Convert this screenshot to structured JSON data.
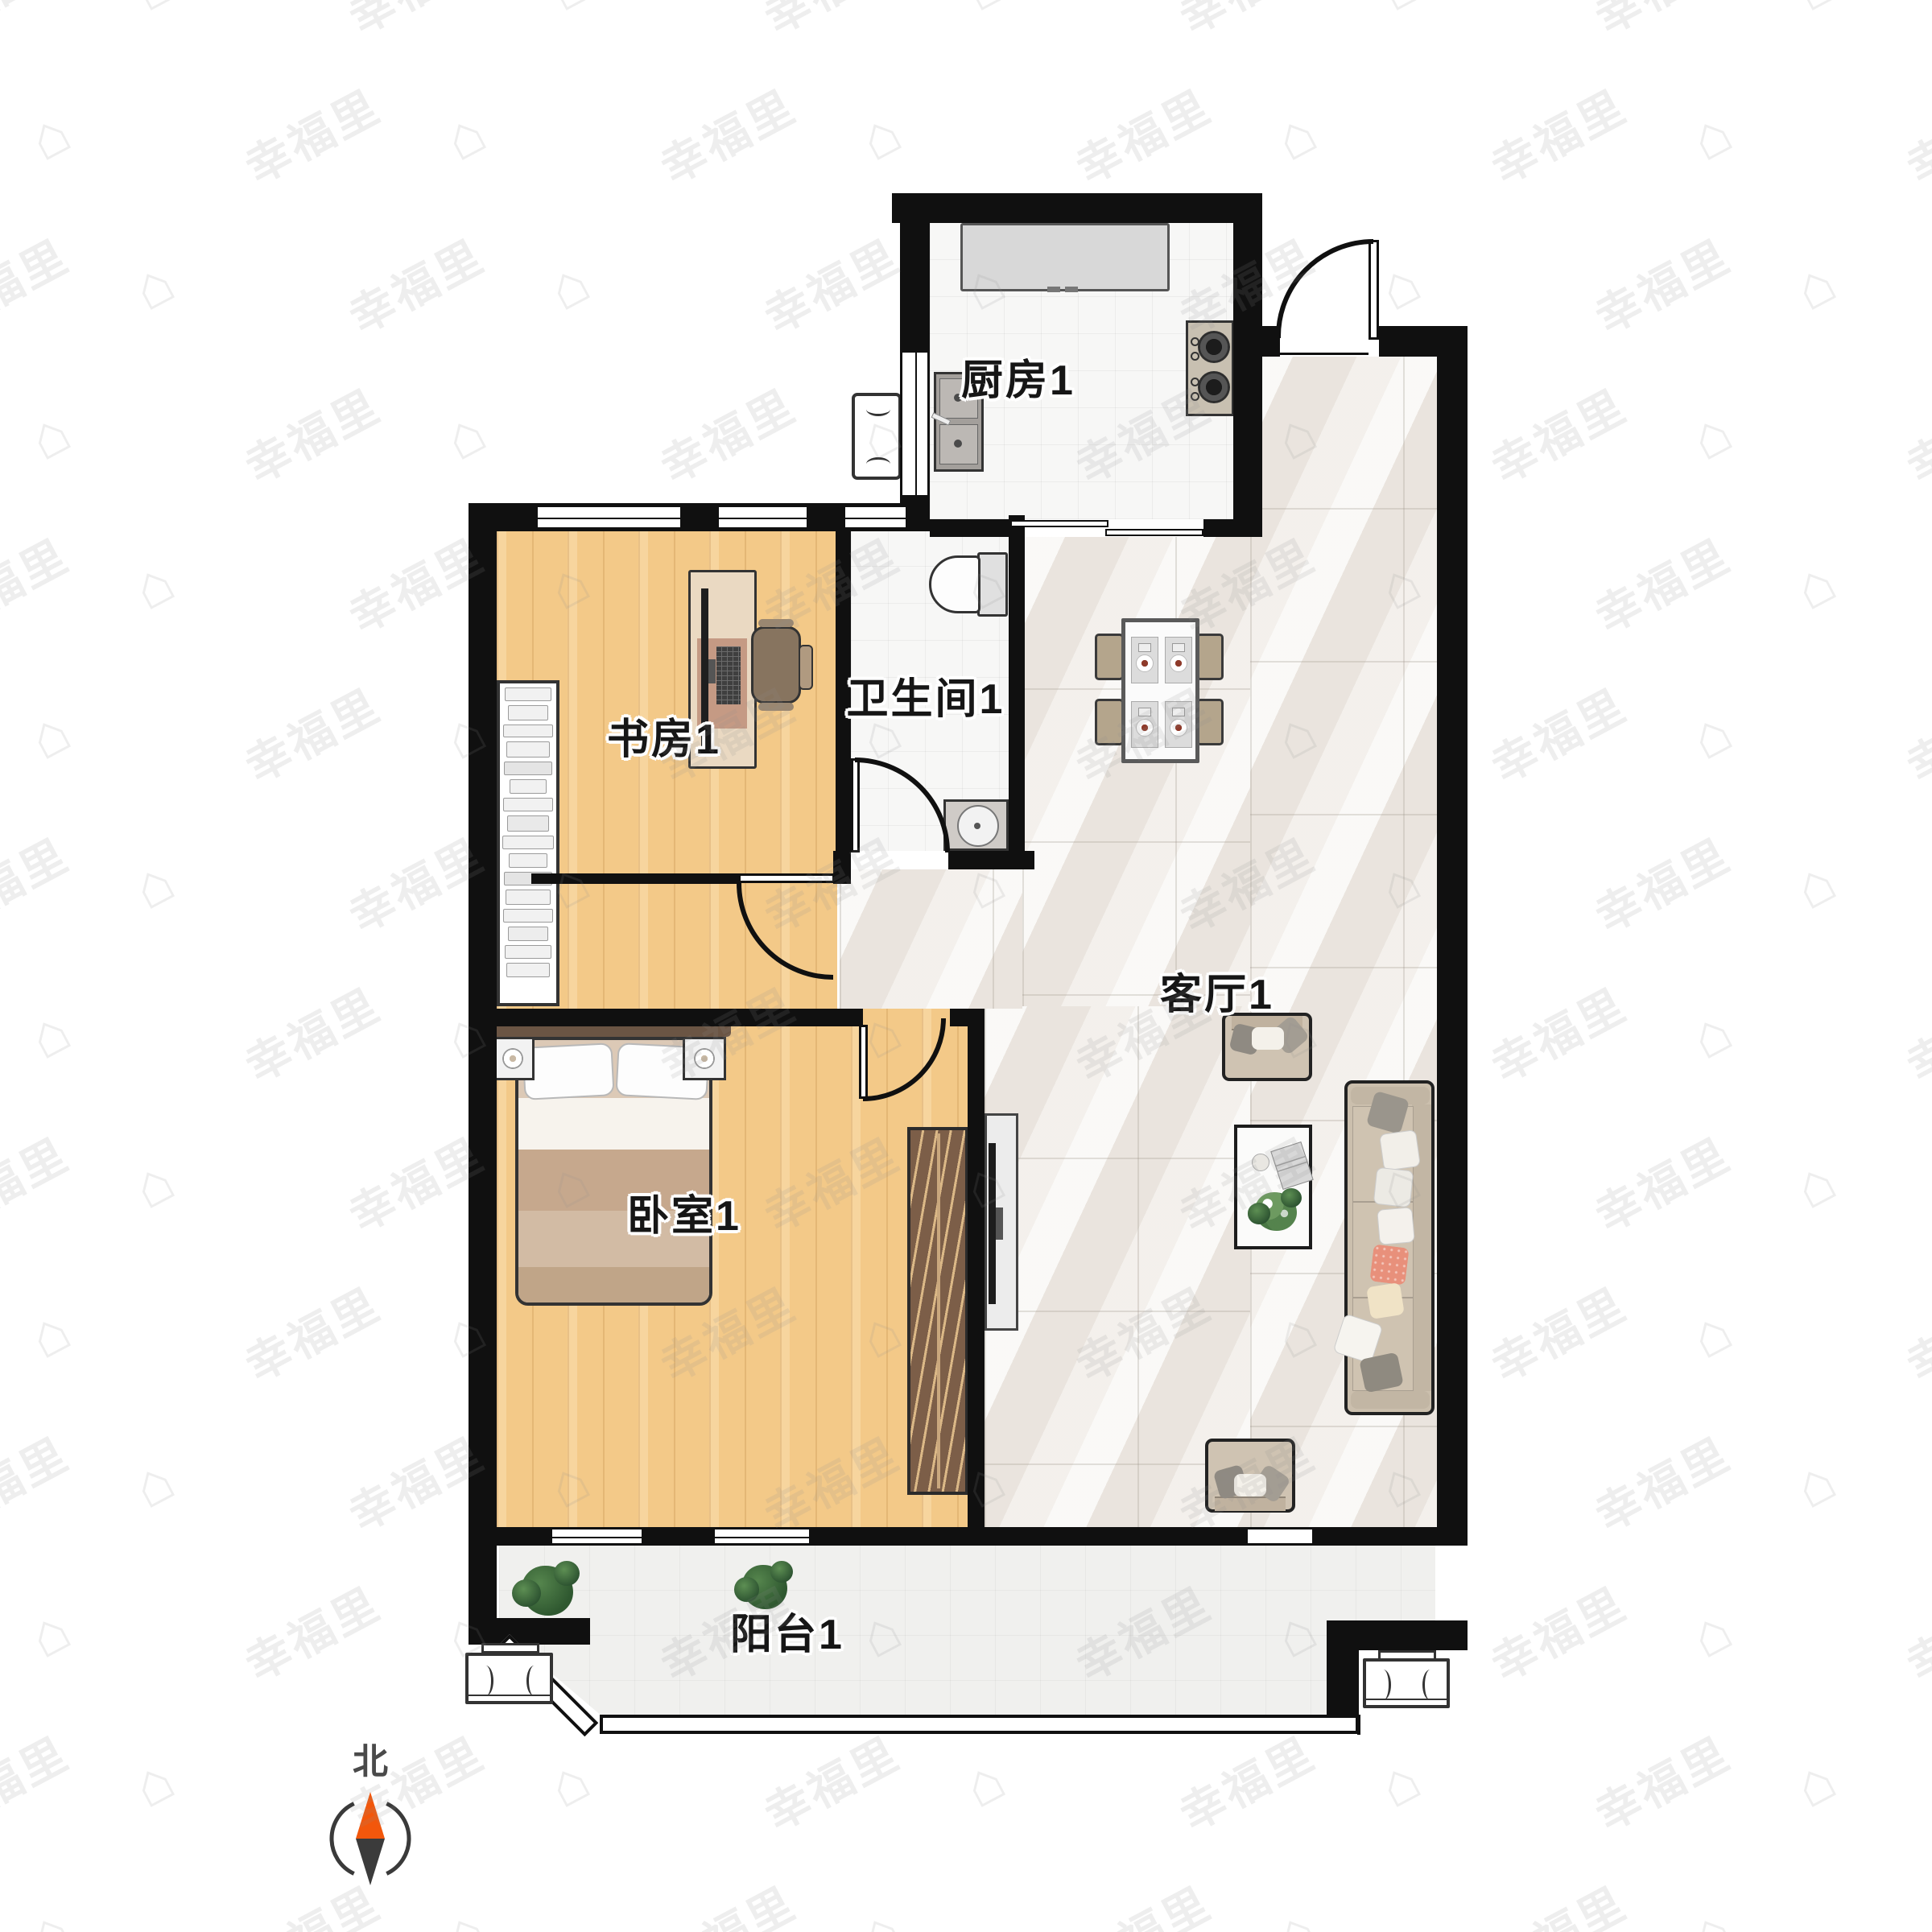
{
  "rooms": {
    "kitchen": {
      "label": "厨房1"
    },
    "bathroom": {
      "label": "卫生间1"
    },
    "study": {
      "label": "书房1"
    },
    "bedroom": {
      "label": "卧室1"
    },
    "living": {
      "label": "客厅1"
    },
    "balcony": {
      "label": "阳台1"
    }
  },
  "compass": {
    "north_label": "北"
  },
  "watermark": {
    "text": "幸福里",
    "icon": "⌂",
    "rows": 14,
    "cols": 10
  },
  "colors": {
    "wall": "#101010",
    "wood_floor": "#f3c988",
    "marble_floor": "#f1ede8",
    "tile_floor": "#f7f7f6",
    "compass_north_needle": "#f2570c",
    "compass_south_needle": "#3b3b3b",
    "label_text": "#161616"
  }
}
